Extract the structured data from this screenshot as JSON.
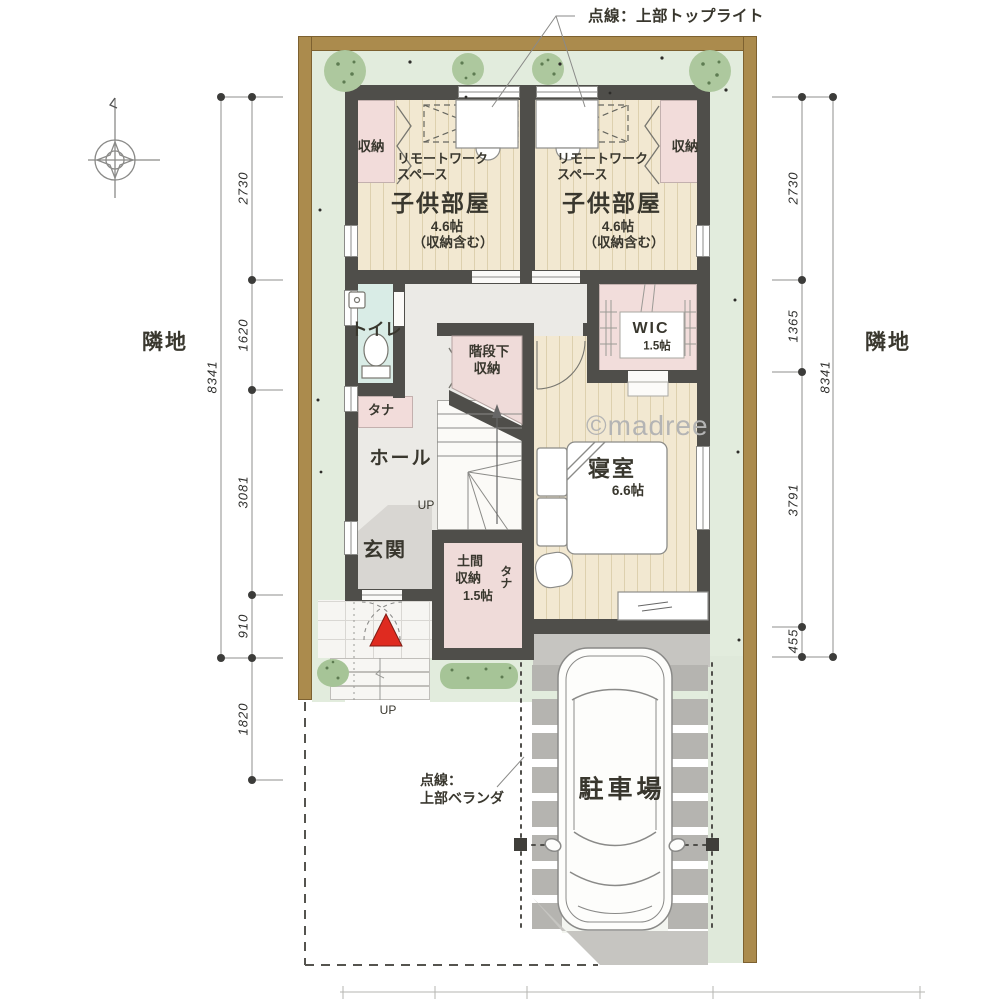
{
  "annotations": {
    "skylight": "点線：上部トップライト",
    "balcony_line1": "点線：",
    "balcony_line2": "上部ベランダ",
    "watermark": "©madree"
  },
  "rooms": {
    "child1": {
      "name": "子供部屋",
      "size": "4.6帖",
      "note": "（収納含む）",
      "remote1": "リモートワーク",
      "remote2": "スペース",
      "closet": "収納"
    },
    "child2": {
      "name": "子供部屋",
      "size": "4.6帖",
      "note": "（収納含む）",
      "remote1": "リモートワーク",
      "remote2": "スペース",
      "closet": "収納"
    },
    "toilet": {
      "name": "トイレ",
      "shelf": "タナ"
    },
    "stair_storage": {
      "line1": "階段下",
      "line2": "収納"
    },
    "wic": {
      "name": "WIC",
      "size": "1.5帖"
    },
    "hall": {
      "name": "ホール",
      "up": "UP"
    },
    "bedroom": {
      "name": "寝室",
      "size": "6.6帖"
    },
    "entrance": {
      "name": "玄関"
    },
    "doma": {
      "line1": "土間",
      "line2": "収納",
      "line3": "1.5帖",
      "shelf": "タナ"
    },
    "porch": {
      "up": "UP"
    },
    "parking": {
      "name": "駐車場"
    }
  },
  "dimensions": {
    "left": {
      "total": "8341",
      "segments": [
        "2730",
        "1620",
        "3081",
        "910",
        "1820"
      ]
    },
    "right": {
      "total": "8341",
      "segments": [
        "2730",
        "1365",
        "3791",
        "455"
      ]
    },
    "neighbor_left": "隣地",
    "neighbor_right": "隣地"
  },
  "colors": {
    "wall": "#4f4e4a",
    "wood": "#f2e8d1",
    "closet_pink": "#f2dcda",
    "toilet_blue": "#d9ece6",
    "yard_green": "#e2ecdd",
    "site_frame_brown": "#ab8b4d",
    "entrance_marker_red": "#df2b20",
    "concrete": "#c6c5c1"
  }
}
